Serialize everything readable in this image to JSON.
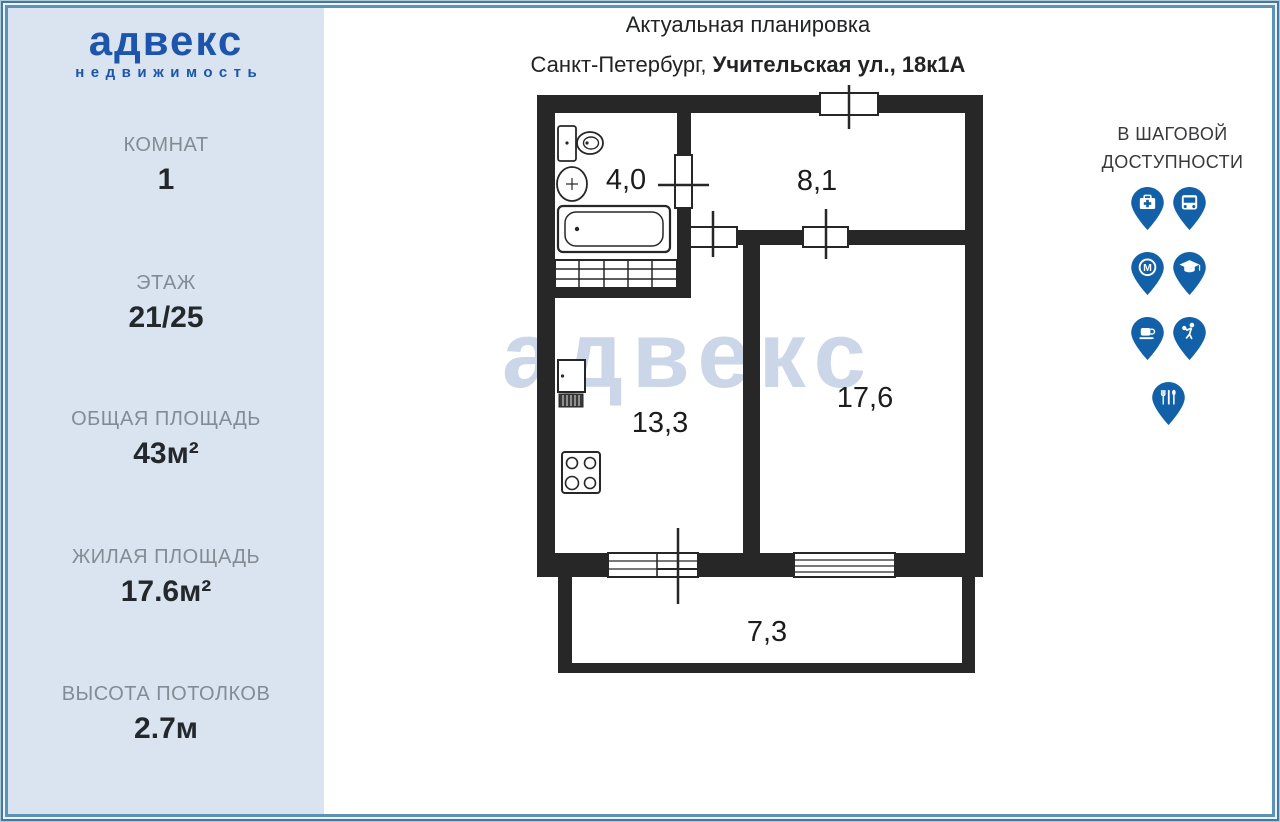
{
  "brand": {
    "logo_title": "адвекс",
    "logo_subtitle": "недвижимость"
  },
  "sidebar": {
    "stats": [
      {
        "label": "КОМНАТ",
        "value": "1"
      },
      {
        "label": "ЭТАЖ",
        "value": "21/25"
      },
      {
        "label": "ОБЩАЯ ПЛОЩАДЬ",
        "value": "43м²"
      },
      {
        "label": "ЖИЛАЯ ПЛОЩАДЬ",
        "value": "17.6м²"
      },
      {
        "label": "ВЫСОТА ПОТОЛКОВ",
        "value": "2.7м"
      }
    ]
  },
  "header": {
    "title": "Актуальная планировка",
    "address_prefix": "Санкт-Петербург, ",
    "address_bold": "Учительская ул., 18к1А"
  },
  "floorplan": {
    "watermark": "адвекс",
    "rooms": [
      {
        "name": "bathroom",
        "area": "4,0"
      },
      {
        "name": "hallway",
        "area": "8,1"
      },
      {
        "name": "kitchen",
        "area": "13,3"
      },
      {
        "name": "living-room",
        "area": "17,6"
      },
      {
        "name": "balcony",
        "area": "7,3"
      }
    ]
  },
  "nearby": {
    "title_line1": "В ШАГОВОЙ",
    "title_line2": "ДОСТУПНОСТИ",
    "pins": [
      {
        "name": "hospital"
      },
      {
        "name": "bus"
      },
      {
        "name": "metro"
      },
      {
        "name": "school"
      },
      {
        "name": "cafe"
      },
      {
        "name": "sport"
      },
      {
        "name": "restaurant"
      }
    ]
  },
  "colors": {
    "brand_blue": "#1d55ac",
    "pin_blue": "#1160a8",
    "sidebar_bg": "#d9e4f0",
    "wall_black": "#272727",
    "watermark": "#ccd6e9",
    "frame_blue_outer": "#47779f",
    "frame_blue_inner": "#5c92ba",
    "label_gray": "#848b94",
    "value_dark": "#24282c"
  }
}
